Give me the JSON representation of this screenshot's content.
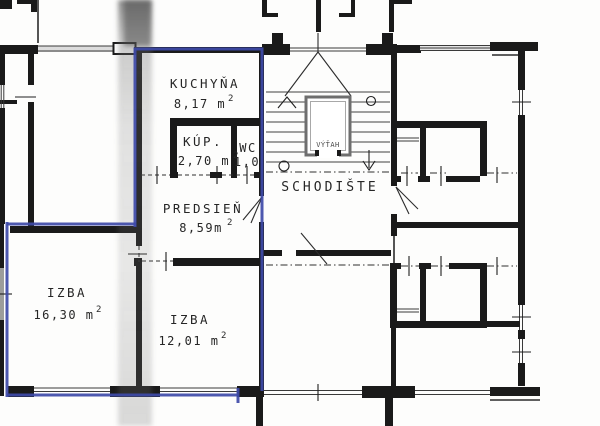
{
  "colors": {
    "highlight_outline": "#3e4aa8",
    "walls": "#1a1a1a",
    "paper": "#fdfdfc",
    "elevator_wall": "#6e6e6e",
    "scan_smudge": "#6f6f6f"
  },
  "rooms": {
    "kitchen": {
      "name": "KUCHYŇA",
      "area": "8,17 m",
      "sup": "2"
    },
    "bathroom": {
      "name": "KÚP.",
      "area": "2,70 m",
      "sup": "2"
    },
    "wc": {
      "name": "WC",
      "area": "1,0",
      "sup": ""
    },
    "hall": {
      "name": "PREDSIEŇ",
      "area": "8,59m",
      "sup": "2"
    },
    "room_left": {
      "name": "IZBA",
      "area": "16,30 m",
      "sup": "2"
    },
    "room_right": {
      "name": "IZBA",
      "area": "12,01 m",
      "sup": "2"
    }
  },
  "common_areas": {
    "staircase": {
      "name": "SCHODIŠTE"
    },
    "elevator": {
      "name": "VÝŤAH"
    }
  }
}
